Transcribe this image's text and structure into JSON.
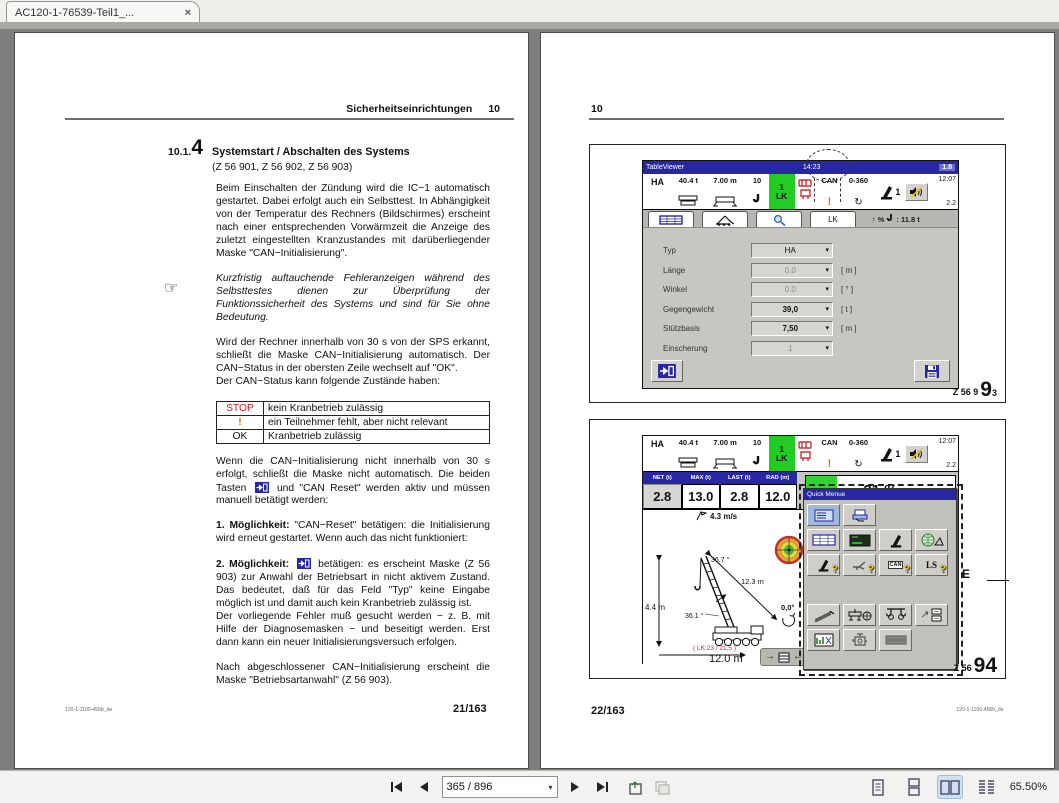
{
  "browser": {
    "tab_title": "AC120-1-76539-Teil1_...",
    "close": "×"
  },
  "icons": {
    "rotation": "↻",
    "hand": "☞",
    "caret": "▾",
    "up": "↑",
    "percent": "%",
    "arrow_right": "→",
    "arrow_left": "←"
  },
  "viewer_toolbar": {
    "page_input": "365 / 896",
    "zoom": "65.50%"
  },
  "left_page": {
    "header_title": "Sicherheitseinrichtungen",
    "header_num": "10",
    "sec_prefix": "10.1.",
    "sec_big": "4",
    "sec_title": "Systemstart / Abschalten des Systems",
    "sec_refs": "(Z 56 901, Z 56 902, Z 56 903)",
    "p1": "Beim Einschalten der Zündung wird die IC−1 automatisch gestartet. Dabei erfolgt auch ein Selbsttest. In Abhängigkeit von der Temperatur des Rechners (Bildschirmes) erscheint nach einer entsprechenden Vorwärmzeit die Anzeige des zuletzt eingestellten Kranzustandes mit darüberliegender Maske \"CAN−Initialisierung\".",
    "note": "Kurzfristig auftauchende Fehleranzeigen während des Selbsttestes dienen zur Überprüfung der Funktionssicherheit des Systems und sind für Sie ohne Bedeutung.",
    "p2": "Wird der Rechner innerhalb von 30 s von der SPS erkannt, schließt die Maske CAN−Initialisierung automatisch. Der CAN−Status in der obersten Zeile wechselt auf \"OK\".",
    "p2b": "Der CAN−Status kann folgende Zustände haben:",
    "can_table": [
      {
        "state": "STOP",
        "desc": "kein Kranbetrieb zulässig"
      },
      {
        "state": "!",
        "desc": "ein Teilnehmer fehlt, aber nicht relevant"
      },
      {
        "state": "OK",
        "desc": "Kranbetrieb zulässig"
      }
    ],
    "p3a": "Wenn die CAN−Initialisierung nicht innerhalb von 30 s erfolgt, schließt die Maske nicht automatisch. Die beiden Tasten",
    "p3b": "und \"CAN Reset\" werden aktiv und müssen manuell betätigt werden:",
    "m1_label": "1. Möglichkeit:",
    "m1_text": "\"CAN−Reset\" betätigen: die Initialisierung wird erneut gestartet. Wenn auch das nicht funktioniert:",
    "m2_label": "2. Möglichkeit:",
    "m2_text": "betätigen: es erscheint Maske (Z 56 903) zur Anwahl der Betriebsart in nicht aktivem Zustand. Das bedeutet, daß für das Feld \"Typ\" keine Eingabe möglich ist und damit auch kein Kranbetrieb zulässig ist.",
    "m2_text2": "Der vorliegende Fehler muß gesucht werden − z. B. mit Hilfe der Diagnosemasken − und beseitigt werden. Erst dann kann ein neuer Initialisierungsversuch erfolgen.",
    "p4": "Nach abgeschlossener CAN−Initialisierung erscheint die Maske \"Betriebsartanwahl\" (Z 56 903).",
    "footer_doc": "120-1-1100-456b_de",
    "footer_page": "21/163"
  },
  "right_page": {
    "header_num": "10",
    "footer_page": "22/163",
    "footer_doc": "120-1-1100-456b_de",
    "fig1_label": {
      "small": "Z 56 9",
      "big": "9",
      "sub": "3"
    },
    "fig2_label": {
      "small": "Z 56",
      "big": "94"
    },
    "callout_e": "E"
  },
  "hmi": {
    "titlebar": {
      "app": "TableViewer",
      "time": "14:23",
      "version": "1.8"
    },
    "status": {
      "mode": "HA",
      "counterweight": "40.4 t",
      "base": "7.00 m",
      "reeving": "10",
      "lk_top": "1",
      "lk": "LK",
      "can": "CAN",
      "alert": "!",
      "range": "0-360",
      "lever_num": "1",
      "clock": "12:07",
      "wind": "2.2"
    },
    "tab_lk": "LK",
    "info_line": ": 11.8 t",
    "form": {
      "rows": [
        {
          "label": "Typ",
          "value": "HA",
          "unit": ""
        },
        {
          "label": "Länge",
          "value": "0.0",
          "unit": "[ m ]"
        },
        {
          "label": "Winkel",
          "value": "0.0",
          "unit": "[ ° ]"
        },
        {
          "label": "Gegengewicht",
          "value": "39,0",
          "unit": "[ t ]"
        },
        {
          "label": "Stützbasis",
          "value": "7,50",
          "unit": "[ m ]"
        },
        {
          "label": "Einscherung",
          "value": "1",
          "unit": ""
        }
      ]
    },
    "load": {
      "headers": [
        "NET (t)",
        "MAX (t)",
        "LAST (t)",
        "RAD (m)"
      ],
      "values": [
        "2.8",
        "13.0",
        "2.8",
        "12.0"
      ],
      "utilization": "21 %",
      "utilization_pct": 21
    },
    "wind_speed": "4.3 m/s",
    "diagram": {
      "boom_top_angle": "36.7 °",
      "boom_length": "12.3 m",
      "height": "4.4 m",
      "boom_angle": "36.1 °",
      "slew": "0,0°",
      "lk_note": "( LK:23 / 21,5 )",
      "radius": "12.0 m"
    },
    "quickmenu_title": "Quick Menue",
    "qm_can": "CAN",
    "qm_ls": "LS",
    "qm_q": "?"
  }
}
